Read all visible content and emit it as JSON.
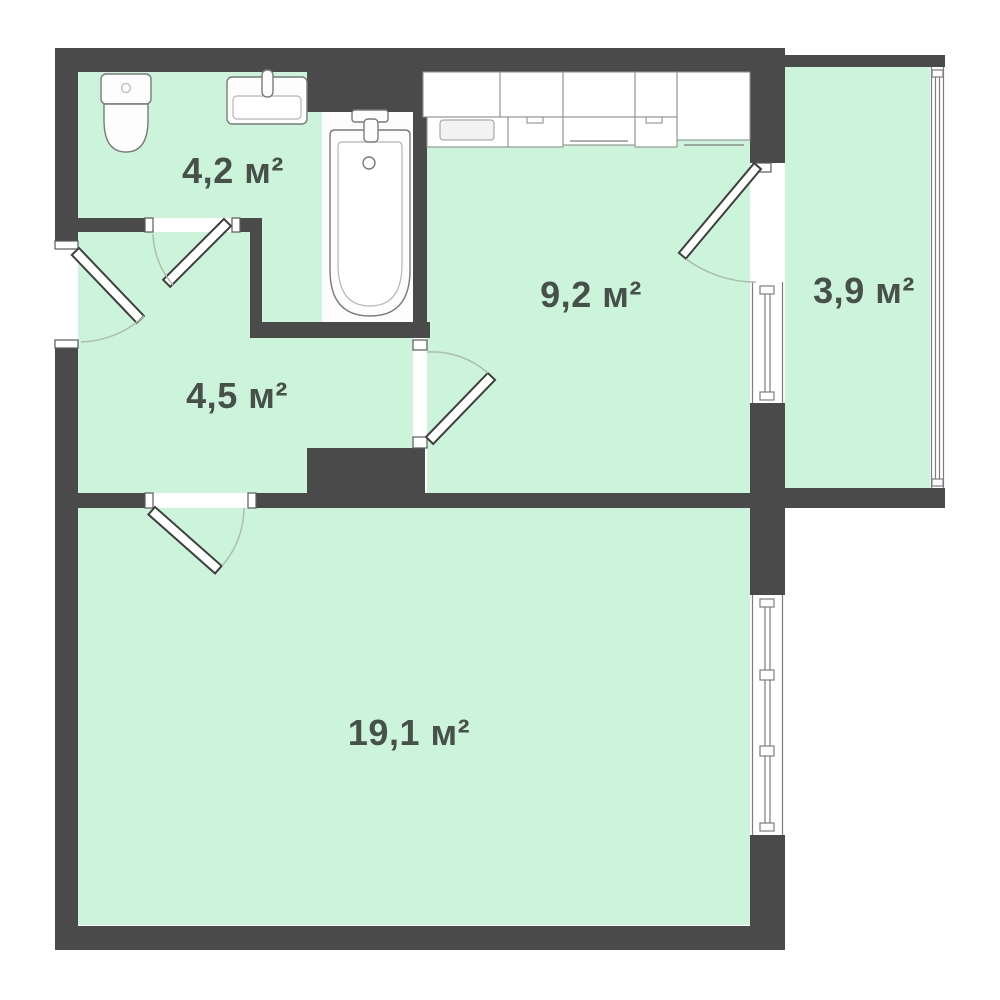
{
  "rooms": [
    {
      "id": "bathroom",
      "area_label": "4,2 м²"
    },
    {
      "id": "hallway",
      "area_label": "4,5 м²"
    },
    {
      "id": "kitchen",
      "area_label": "9,2 м²"
    },
    {
      "id": "balcony",
      "area_label": "3,9 м²"
    },
    {
      "id": "living-room",
      "area_label": "19,1 м²"
    }
  ],
  "fixtures": [
    "toilet-icon",
    "sink-icon",
    "bathtub-icon",
    "kitchen-counter"
  ],
  "doors": [
    "entrance-door",
    "bathroom-door",
    "kitchen-door",
    "balcony-door",
    "living-room-door"
  ],
  "windows": [
    "window-kitchen-balcony",
    "window-living-room",
    "window-balcony"
  ],
  "colors": {
    "wall": "#4a4a4a",
    "floor": "#ccf4da",
    "background": "#ffffff",
    "label_text": "#475049",
    "fixture_stroke": "#7a7a7a",
    "door_arc": "#aebcb2"
  }
}
